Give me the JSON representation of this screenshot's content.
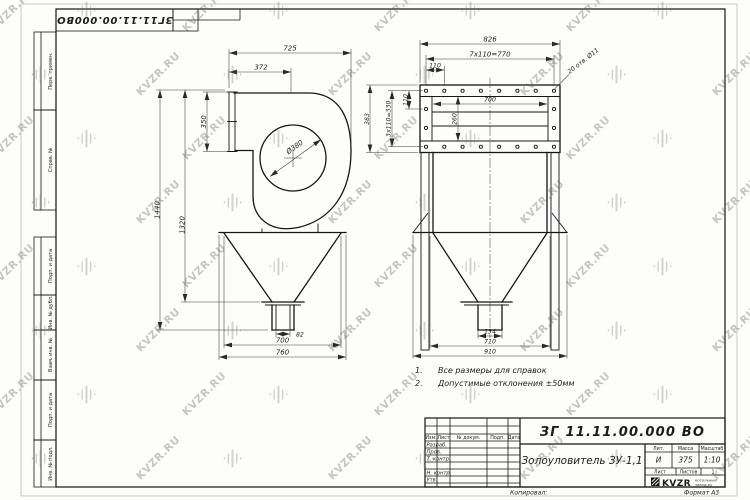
{
  "watermark": {
    "text": "KVZR.RU"
  },
  "corner_stamp": {
    "doc_number": "ЗГ11.11.00.000ВО"
  },
  "margin": {
    "labels": [
      "Перв. примен.",
      "Справ. №",
      "Подп. и дата",
      "Инв. № дубл.",
      "Взам. инв. №",
      "Подп. и дата",
      "Инв. № подл."
    ]
  },
  "notes": {
    "n1_num": "1.",
    "n1_text": "Все размеры для справок",
    "n2_num": "2.",
    "n2_text": "Допустимые отклонения ±50мм"
  },
  "left_view": {
    "dims": {
      "overall_width": "725",
      "inlet_to_axis": "372",
      "inlet_flange_height": "350",
      "impeller_diameter": "Ø380",
      "overall_height": "1440",
      "body_height": "1320",
      "outlet_pipe": "82",
      "hopper_width": "700",
      "hopper_flange_width": "760"
    }
  },
  "right_view": {
    "dims": {
      "overall_width": "826",
      "bolt_pitch_horizontal": "7x110=770",
      "bolt_pitch_first": "110",
      "bolt_holes_note": "20 отв. Ø11",
      "inner_width": "700",
      "flange_height": "383",
      "bolt_pitch_vertical": "3x110=330",
      "bolt_pitch_v_first": "110",
      "inner_height": "260",
      "outlet_width": "134",
      "hopper_width": "710",
      "base_width": "910"
    }
  },
  "title_block": {
    "doc_number": "ЗГ 11.11.00.000 ВО",
    "name": "Золоуловитель ЗУ-1,1",
    "columns": {
      "izm": "Изм.",
      "list": "Лист",
      "doc": "№ докум.",
      "podp": "Подп.",
      "data": "Дата"
    },
    "rows": {
      "razrab": "Разраб.",
      "prov": "Пров.",
      "tkontr": "Т. контр.",
      "nkontr": "Н. контр.",
      "utv": "Утв."
    },
    "lit_label": "Лит.",
    "mass_label": "Масса",
    "scale_label": "Масштаб",
    "lit_value": "И",
    "mass_value": "375",
    "scale_value": "1:10",
    "sheet_label": "Лист",
    "sheets_label": "Листов",
    "sheets_value": "1",
    "logo": {
      "name": "KVZR",
      "tagline_top": "котельный",
      "tagline_bottom": "завод.ру"
    },
    "copied_label": "Копировал:",
    "format_label": "Формат А3"
  }
}
